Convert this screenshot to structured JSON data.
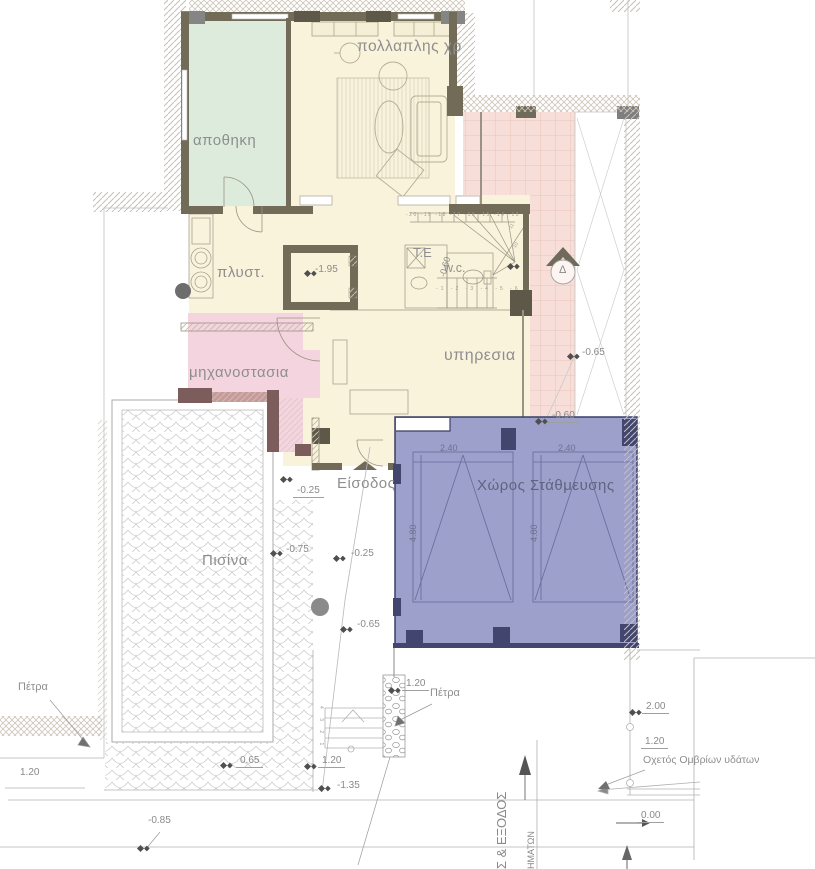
{
  "rooms": {
    "storage": "αποθηκη",
    "multipurpose": "πολλαπλης χρ",
    "laundry": "πλυστ.",
    "machine_room": "μηχανοστασια",
    "service": "υπηρεσια",
    "wc": "w.c.",
    "technical": "T.E",
    "pool": "Πισίνα",
    "parking": "Χώρος Στάθμευσης",
    "entrance": "Είσοδος"
  },
  "levels": {
    "elevator_pit": "-1.95",
    "stair_winder": "-0.60",
    "walkway": "-0.65",
    "parking_slab": "-0.60",
    "entrance_step": "-0.25",
    "pool_deck_west": "-0.75",
    "path_upper": "-0.25",
    "path_lower": "-0.65",
    "stone_wall_top": "1.20",
    "garden_step": "0.65",
    "path_bottom": "1.20",
    "ramp_bottom": "-1.35",
    "street": "-0.85",
    "boundary_upper": "2.00",
    "boundary_mid": "1.20",
    "street_zero": "0.00",
    "retaining_wall": "1.20"
  },
  "dimensions": {
    "stall_width": "2.40",
    "stall_length": "4.80"
  },
  "annotations": {
    "stone_label_left": "Πέτρα",
    "stone_label_right": "Πέτρα",
    "storm_drain": "Οχετός Ομβρίων υδάτων",
    "gate_text": "Σ & ΕΞΟΔΟΣ",
    "vehicles_text": "ΗΜΑΤΩΝ",
    "section_mark": "Δ"
  },
  "stairs": {
    "upper_treads": "-20 -19 -18 -17 -16 -15 -14 -13",
    "winder_a": "-11",
    "winder_b": "-10",
    "lower_treads": "-1 -2 -3 -4 -5 -6",
    "exterior_treads": "4 3 2 1"
  },
  "colors": {
    "floor_cream": "#faf3dc",
    "storage_green": "#dcebdb",
    "machine_pink": "#f4d5df",
    "tile_pink": "#f7ded8",
    "parking_blue": "#9da0cb",
    "parking_dark": "#42466e",
    "wall_olive": "#716b58"
  }
}
